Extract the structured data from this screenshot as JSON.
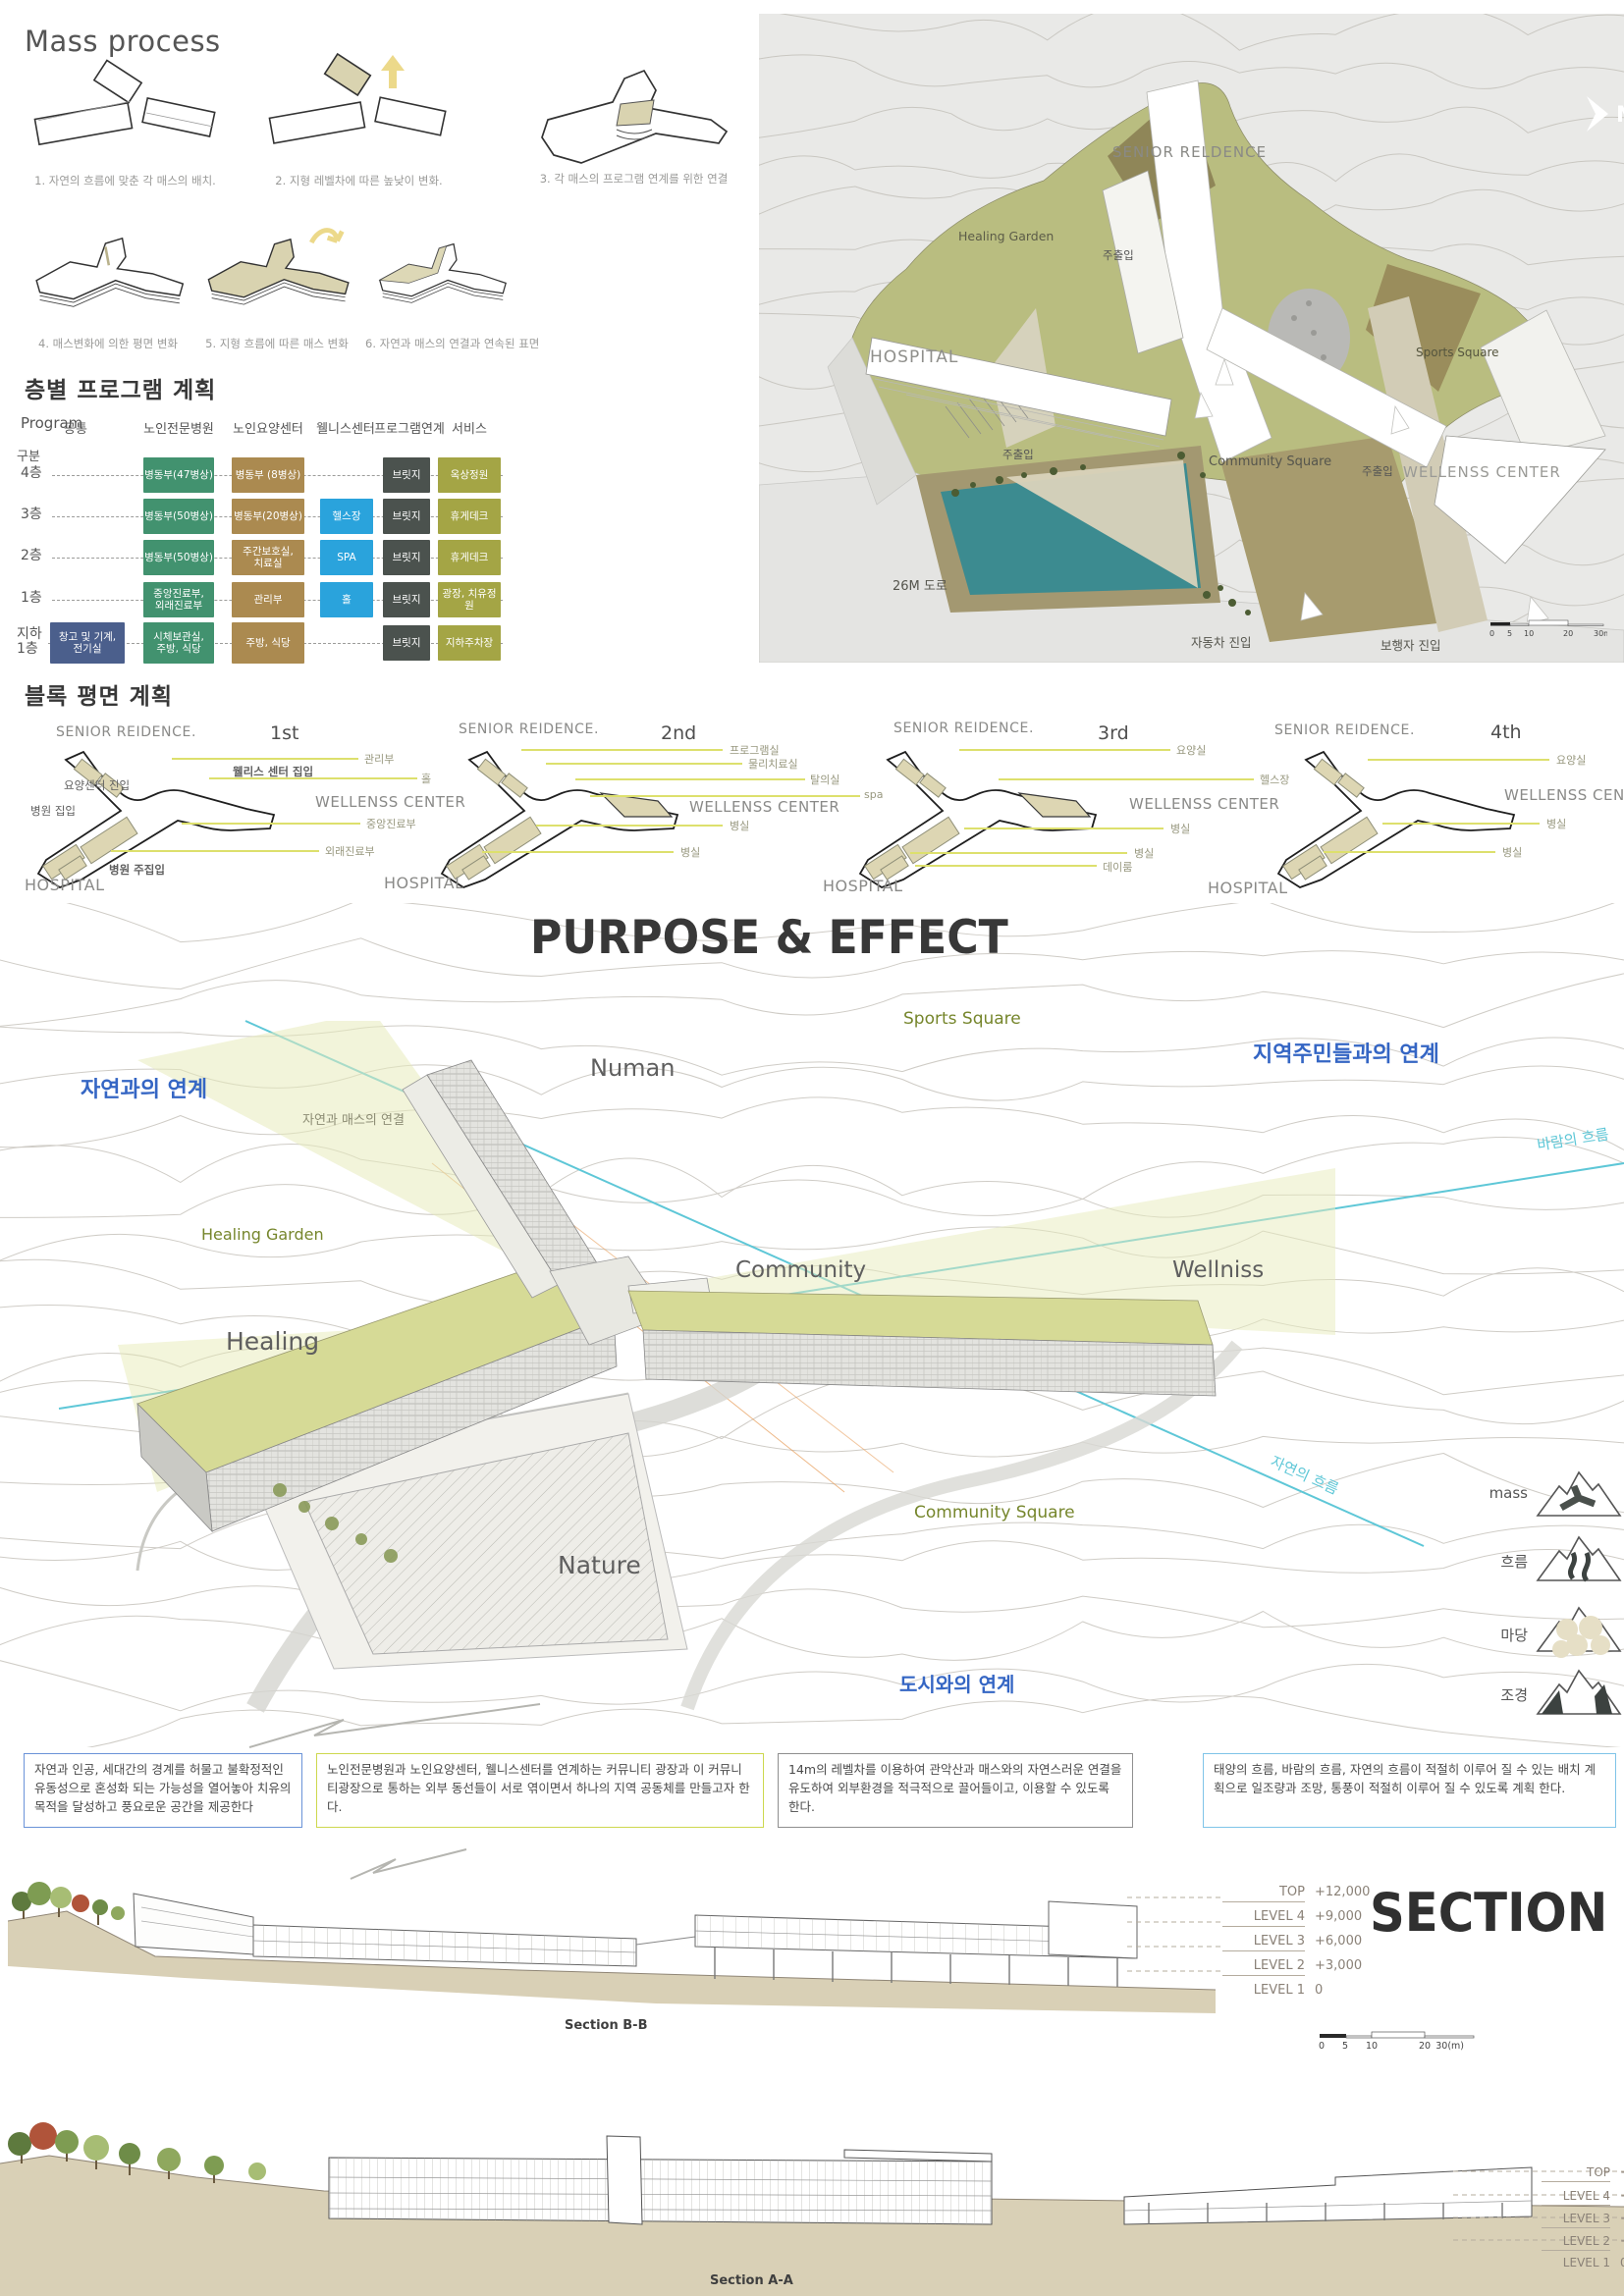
{
  "mass_process": {
    "title": "Mass process",
    "captions": [
      "1. 자연의 흐름에 맞춘 각 매스의 배치.",
      "2. 지형 레벨차에 따른 높낮이 변화.",
      "3. 각 매스의 프로그램 연계를 위한 연결",
      "4. 매스변화에 의한 평면 변화",
      "5. 지형 흐름에 따른 매스 변화",
      "6. 자연과 매스의 연결과 연속된 표면"
    ]
  },
  "program_table": {
    "title": "층별 프로그램 계획",
    "corner_top": "Program",
    "corner_bottom": "구분",
    "headers": [
      "공통",
      "노인전문병원",
      "노인요양센터",
      "웰니스센터",
      "프로그램연계",
      "서비스"
    ],
    "rows": [
      {
        "floor": "4층",
        "hospital": "병동부(47병상)",
        "care": "병동부 (8병상)",
        "bridge": "브릿지",
        "service": "옥상정원"
      },
      {
        "floor": "3층",
        "hospital": "병동부(50병상)",
        "care": "병동부(20병상)",
        "wellness": "헬스장",
        "bridge": "브릿지",
        "service": "휴게데크"
      },
      {
        "floor": "2층",
        "hospital": "병동부(50병상)",
        "care": "주간보호실,\n치료실",
        "wellness": "SPA",
        "bridge": "브릿지",
        "service": "휴게데크"
      },
      {
        "floor": "1층",
        "hospital": "중앙진료부,\n외래진료부",
        "care": "관리부",
        "wellness": "홀",
        "bridge": "브릿지",
        "service": "광장, 치유정원"
      },
      {
        "floor": "지하\n1층",
        "common": "창고 및 기계,\n전기실",
        "hospital": "시체보관실,\n주방, 식당",
        "care": "주방, 식당",
        "bridge": "브릿지",
        "service": "지하주차장"
      }
    ]
  },
  "site_plan": {
    "title_bold": "SITE",
    "title_light": "PLAN",
    "north_letter": "N",
    "labels": {
      "senior": "SENIOR RELDENCE",
      "healing_garden": "Healing Garden",
      "entry_top": "주출입",
      "hospital": "HOSPITAL",
      "sports_square": "Sports Square",
      "entry_mid": "주출입",
      "community_square": "Community Square",
      "entry_right": "주출입",
      "wellness": "WELLENSS CENTER",
      "road": "26M 도로",
      "car_entry": "자동차 진입",
      "ped_entry": "보행자 진입"
    },
    "scale_ticks": [
      "0",
      "5",
      "10",
      "20",
      "30m"
    ]
  },
  "block_plans": {
    "title": "블록 평면 계획",
    "plans": [
      {
        "floor": "1st",
        "senior": "SENIOR REIDENCE.",
        "wellness": "WELLENSS CENTER",
        "hospital": "HOSPITAL",
        "c0": "관리부",
        "c1": "웰리스 센터 집입",
        "c2": "홀",
        "c3": "요양센터 진입",
        "c4": "병원 집입",
        "c5": "중앙진료부",
        "c6": "외래진료부",
        "c7": "병원 주집입"
      },
      {
        "floor": "2nd",
        "senior": "SENIOR REIDENCE.",
        "wellness": "WELLENSS CENTER",
        "hospital": "HOSPITAL",
        "c0": "프로그램실",
        "c1": "물리치료실",
        "c2": "탈의실",
        "c3": "spa",
        "c4": "병실",
        "c5": "병실"
      },
      {
        "floor": "3rd",
        "senior": "SENIOR REIDENCE.",
        "wellness": "WELLENSS CENTER",
        "hospital": "HOSPITAL",
        "c0": "요양실",
        "c1": "헬스장",
        "c2": "병실",
        "c3": "병실",
        "c4": "데이룸"
      },
      {
        "floor": "4th",
        "senior": "SENIOR REIDENCE.",
        "wellness": "WELLENSS CENTER",
        "hospital": "HOSPITAL",
        "c0": "요양실",
        "c1": "병실",
        "c2": "병실"
      }
    ]
  },
  "purpose": {
    "title": "PURPOSE & EFFECT",
    "labels": {
      "sports_square": "Sports Square",
      "community_link": "지역주민들과의 연계",
      "nature_link": "자연과의 연계",
      "numan": "Numan",
      "nature_mass": "자연과 매스의 연결",
      "healing_garden": "Healing Garden",
      "community": "Community",
      "wellniss": "Wellniss",
      "healing": "Healing",
      "wind_flow": "바람의 흐름",
      "community_square": "Community Square",
      "nature": "Nature",
      "nature_flow": "자연의 흐름",
      "city_link": "도시와의 연계"
    },
    "legend": [
      {
        "label": "mass"
      },
      {
        "label": "흐름"
      },
      {
        "label": "마당"
      },
      {
        "label": "조경"
      }
    ]
  },
  "notes": [
    {
      "text": "자연과 인공, 세대간의 경계를 허물고 불확정적인 유동성으로 혼성화 되는 가능성을 열어놓아 치유의 목적을 달성하고 풍요로운 공간을 제공한다"
    },
    {
      "text": "노인전문병원과 노인요양센터, 웰니스센터를 연계하는 커뮤니티 광장과 이 커뮤니티광장으로 통하는 외부 동선들이 서로 엮이면서 하나의 지역 공동체를 만들고자 한다."
    },
    {
      "text": "14m의 레벨차를 이용하여 관악산과 매스와의 자연스러운 연결을 유도하여 외부환경을 적극적으로 끌어들이고, 이용할 수 있도록 한다."
    },
    {
      "text": "태양의 흐름, 바람의 흐름, 자연의 흐름이 적절히 이루어 질 수 있는 배치 계획으로 일조량과 조망, 통풍이 적절히 이루어 질 수 있도록 계획 한다."
    }
  ],
  "sections": {
    "title": "SECTION",
    "scale_ticks": [
      "0",
      "5",
      "10",
      "20",
      "30(m)"
    ],
    "bb": {
      "label": "Section B-B",
      "levels": [
        {
          "name": "TOP",
          "value": "+12,000"
        },
        {
          "name": "LEVEL 4",
          "value": "+9,000"
        },
        {
          "name": "LEVEL 3",
          "value": "+6,000"
        },
        {
          "name": "LEVEL 2",
          "value": "+3,000"
        },
        {
          "name": "LEVEL 1",
          "value": "0"
        }
      ]
    },
    "aa": {
      "label": "Section A-A",
      "levels": [
        {
          "name": "TOP",
          "value": "+12,000"
        },
        {
          "name": "LEVEL 4",
          "value": "+9,000"
        },
        {
          "name": "LEVEL 3",
          "value": "+6,000"
        },
        {
          "name": "LEVEL 2",
          "value": "+3,000"
        },
        {
          "name": "LEVEL 1",
          "value": "0"
        }
      ]
    }
  },
  "colors": {
    "hospital_green": "#42926F",
    "care_brown": "#AB8A50",
    "wellness_blue": "#2AA3DC",
    "bridge_gray": "#4B524E",
    "service_olive": "#A4A545",
    "common_navy": "#4B5F8C",
    "accent_blue": "#3566C4",
    "flow_cyan": "#5EC7D7",
    "label_olive": "#76862C",
    "callout_yellow": "#DDE06D",
    "hill_green": "#B9BD80",
    "pond_teal": "#3C8B90"
  }
}
